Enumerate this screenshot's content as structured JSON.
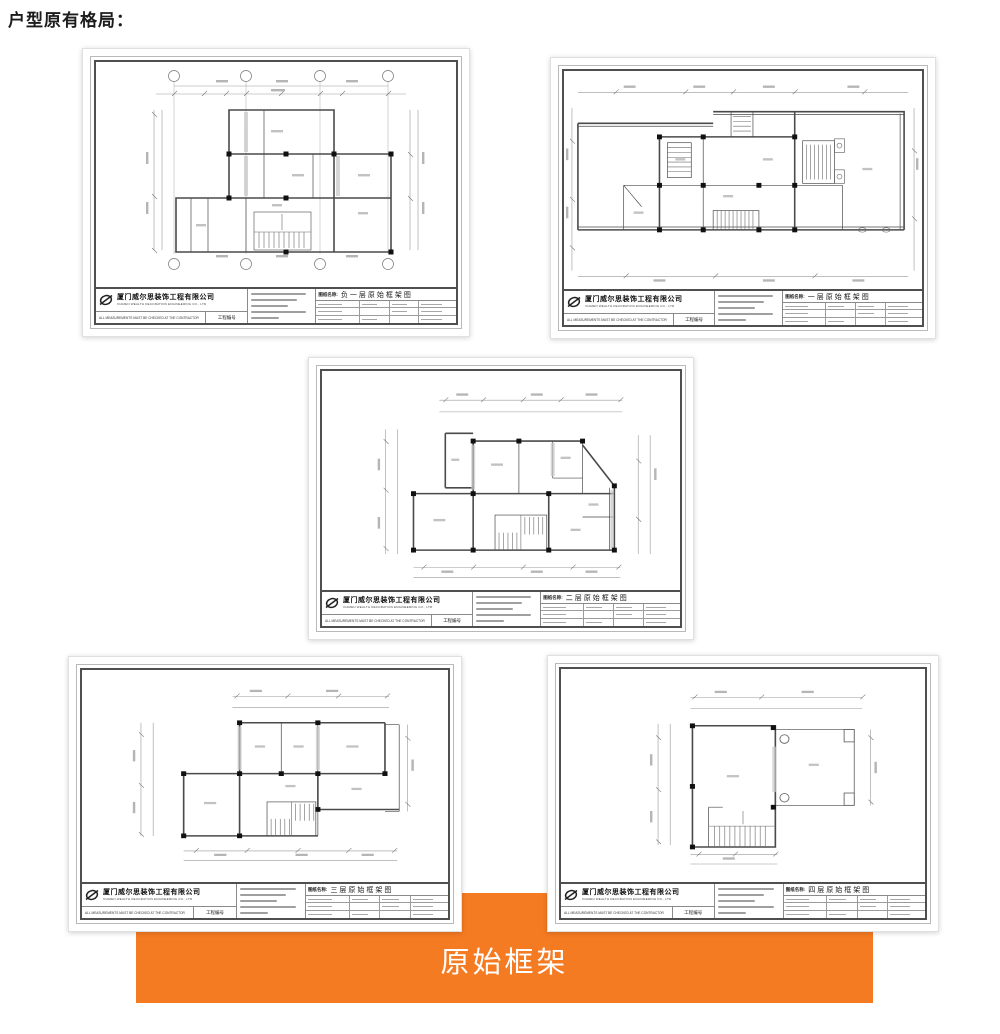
{
  "page": {
    "heading": "户型原有格局："
  },
  "banner": {
    "label": "原始框架",
    "background": "#f57b22",
    "text_color": "#ffffff"
  },
  "company": {
    "name_cn": "厦门威尔思装饰工程有限公司",
    "name_en": "XIAMEN WEALTH DECORATION ENGINEERING CO., LTD"
  },
  "title_block": {
    "drawing_name_label": "图纸名称:",
    "project_no_label": "工程编号",
    "footer_note": "ALL MEASUREMENTS MUST BE CHECKED AT THE CONTRACTOR"
  },
  "sheets": [
    {
      "title": "负一层原始框架图"
    },
    {
      "title": "一层原始框架图"
    },
    {
      "title": "二层原始框架图"
    },
    {
      "title": "三层原始框架图"
    },
    {
      "title": "四层原始框架图"
    }
  ]
}
